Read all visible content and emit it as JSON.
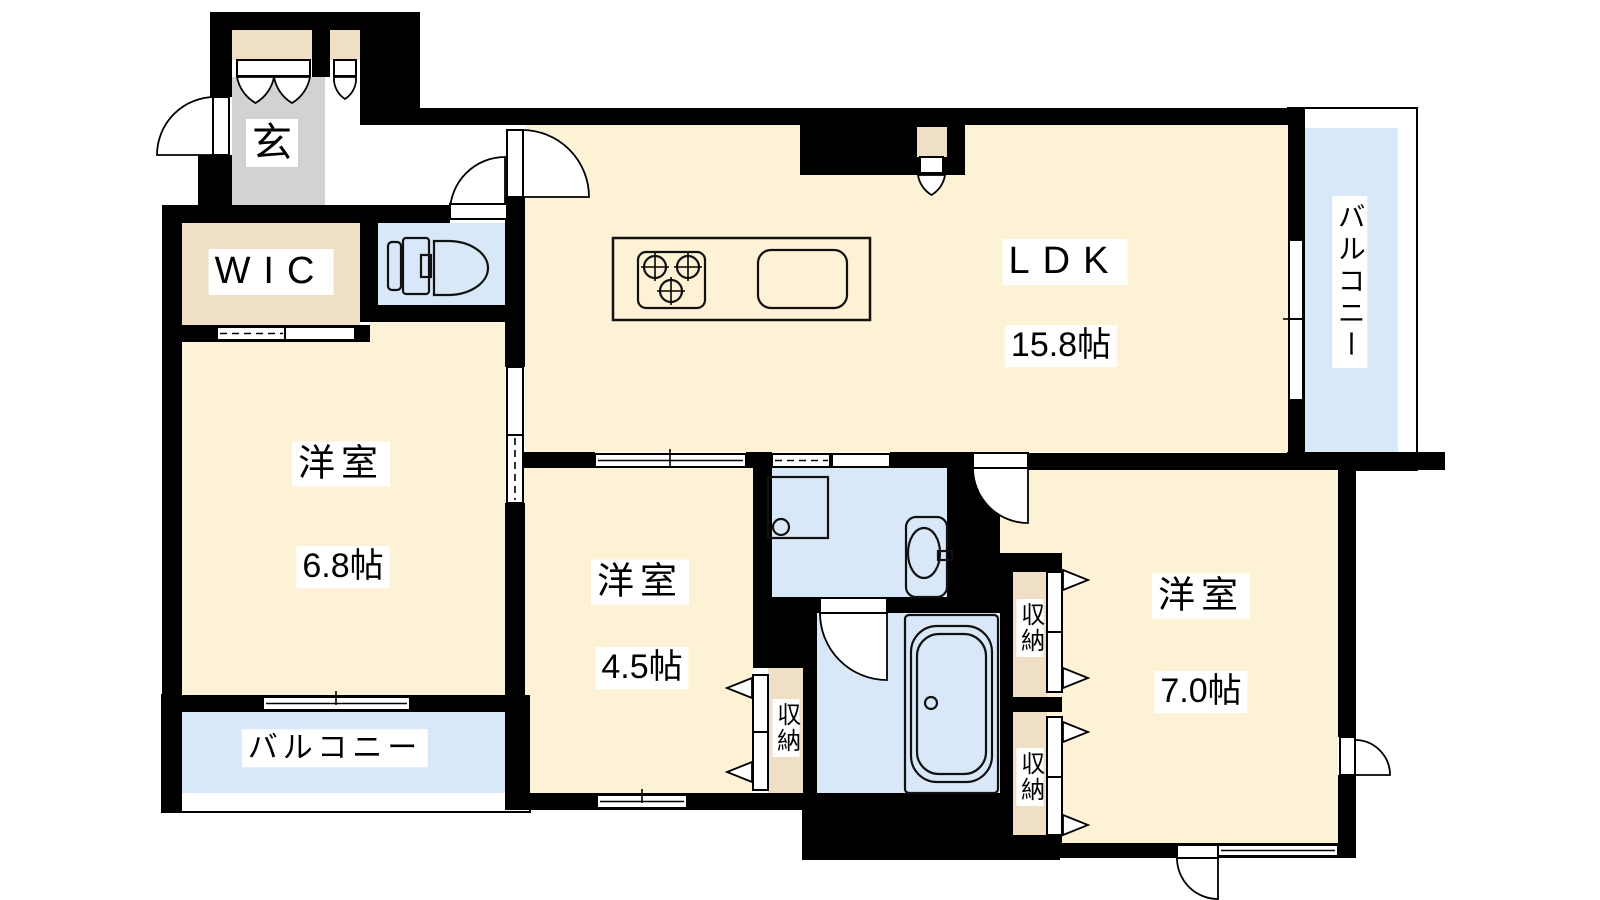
{
  "floorplan": {
    "type": "apartment-floor-plan",
    "rooms": [
      {
        "id": "genkan",
        "label": "玄"
      },
      {
        "id": "wic",
        "label": "WIC"
      },
      {
        "id": "ldk",
        "label": "LDK",
        "size": "15.8帖"
      },
      {
        "id": "bedroom-left",
        "label": "洋室",
        "size": "6.8帖"
      },
      {
        "id": "bedroom-middle",
        "label": "洋室",
        "size": "4.5帖"
      },
      {
        "id": "bedroom-right",
        "label": "洋室",
        "size": "7.0帖"
      },
      {
        "id": "balcony-right",
        "label": "バルコニー"
      },
      {
        "id": "balcony-bottom",
        "label": "バルコニー"
      },
      {
        "id": "storage-middle",
        "label": "収納"
      },
      {
        "id": "storage-right-upper",
        "label": "収納"
      },
      {
        "id": "storage-right-lower",
        "label": "収納"
      }
    ],
    "colors": {
      "wall": "#000000",
      "room-floor": "#FDF2D6",
      "closet-floor": "#EFDFC4",
      "entrance-floor": "#D2D2D2",
      "wet-floor": "#D9E8F8",
      "label-bg": "#FFFFFF"
    }
  }
}
